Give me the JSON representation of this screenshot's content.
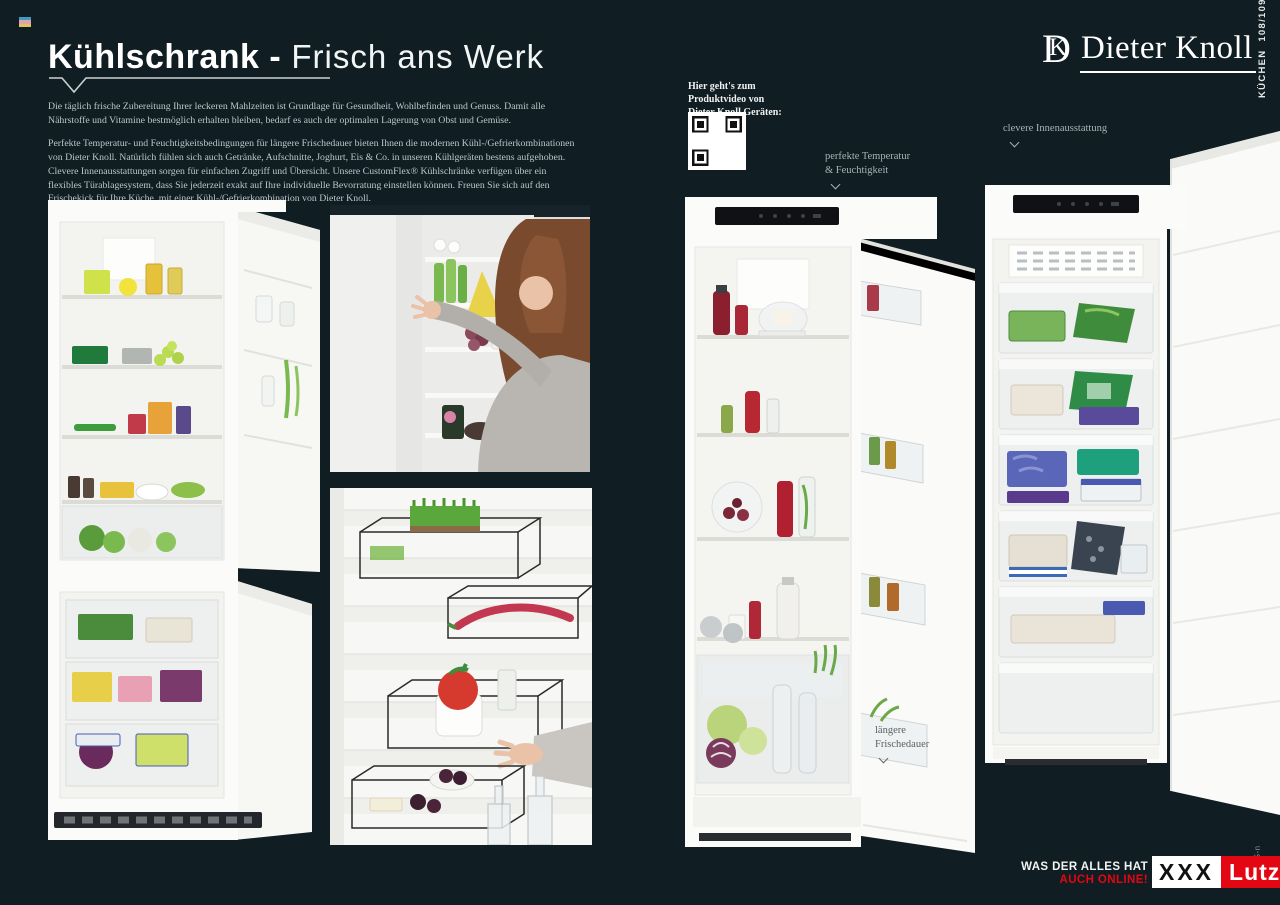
{
  "page": {
    "background": "#101d22",
    "registration_mark_colors": [
      "#3f9cba",
      "#e4a2ae",
      "#dcc85c"
    ]
  },
  "header": {
    "title_bold": "Kühlschrank -",
    "title_light": " Frisch ans Werk",
    "paragraph1": "Die täglich frische Zubereitung Ihrer leckeren Mahlzeiten ist Grundlage für Gesundheit, Wohlbefinden und Genuss. Damit alle Nährstoffe und Vitamine bestmöglich erhalten bleiben, bedarf es auch der optimalen Lagerung von Obst und Gemüse.",
    "paragraph2": "Perfekte Temperatur- und Feuchtigkeitsbedingungen für längere Frischedauer bieten Ihnen die modernen Kühl-/Gefrierkombinationen von Dieter Knoll. Natürlich fühlen sich auch Getränke, Aufschnitte, Joghurt, Eis & Co. in unseren Kühlgeräten bestens aufgehoben. Clevere Innenausstattungen sorgen für einfachen Zugriff und Übersicht. Unsere CustomFlex® Kühlschränke verfügen über ein flexibles Türablagesystem, dass Sie jederzeit exakt auf Ihre individuelle Bevorratung einstellen können. Freuen Sie sich auf den Frischekick für Ihre Küche, mit einer Kühl-/Gefrierkombination von Dieter Knoll."
  },
  "qr_block": {
    "caption": "Hier geht's zum\nProduktvideo von\nDieter Knoll Geräten:"
  },
  "brand": {
    "monogram_d": "D",
    "monogram_k": "K",
    "name": "Dieter Knoll",
    "page_marker": "KÜCHEN  108/109"
  },
  "annotations": {
    "innenausstattung": "clevere Innenausstattung",
    "temperatur": "perfekte Temperatur\n& Feuchtigkeit",
    "frischedauer": "längere\nFrischedauer"
  },
  "footer": {
    "claim": "WAS DER ALLES HAT",
    "claim_online": "AUCH ONLINE!",
    "logo_xxx": "XXX",
    "logo_lutz": "Lutz",
    "print_code": "LAT12-S-n"
  },
  "colors": {
    "accent_red": "#e30613",
    "background": "#101d22"
  }
}
